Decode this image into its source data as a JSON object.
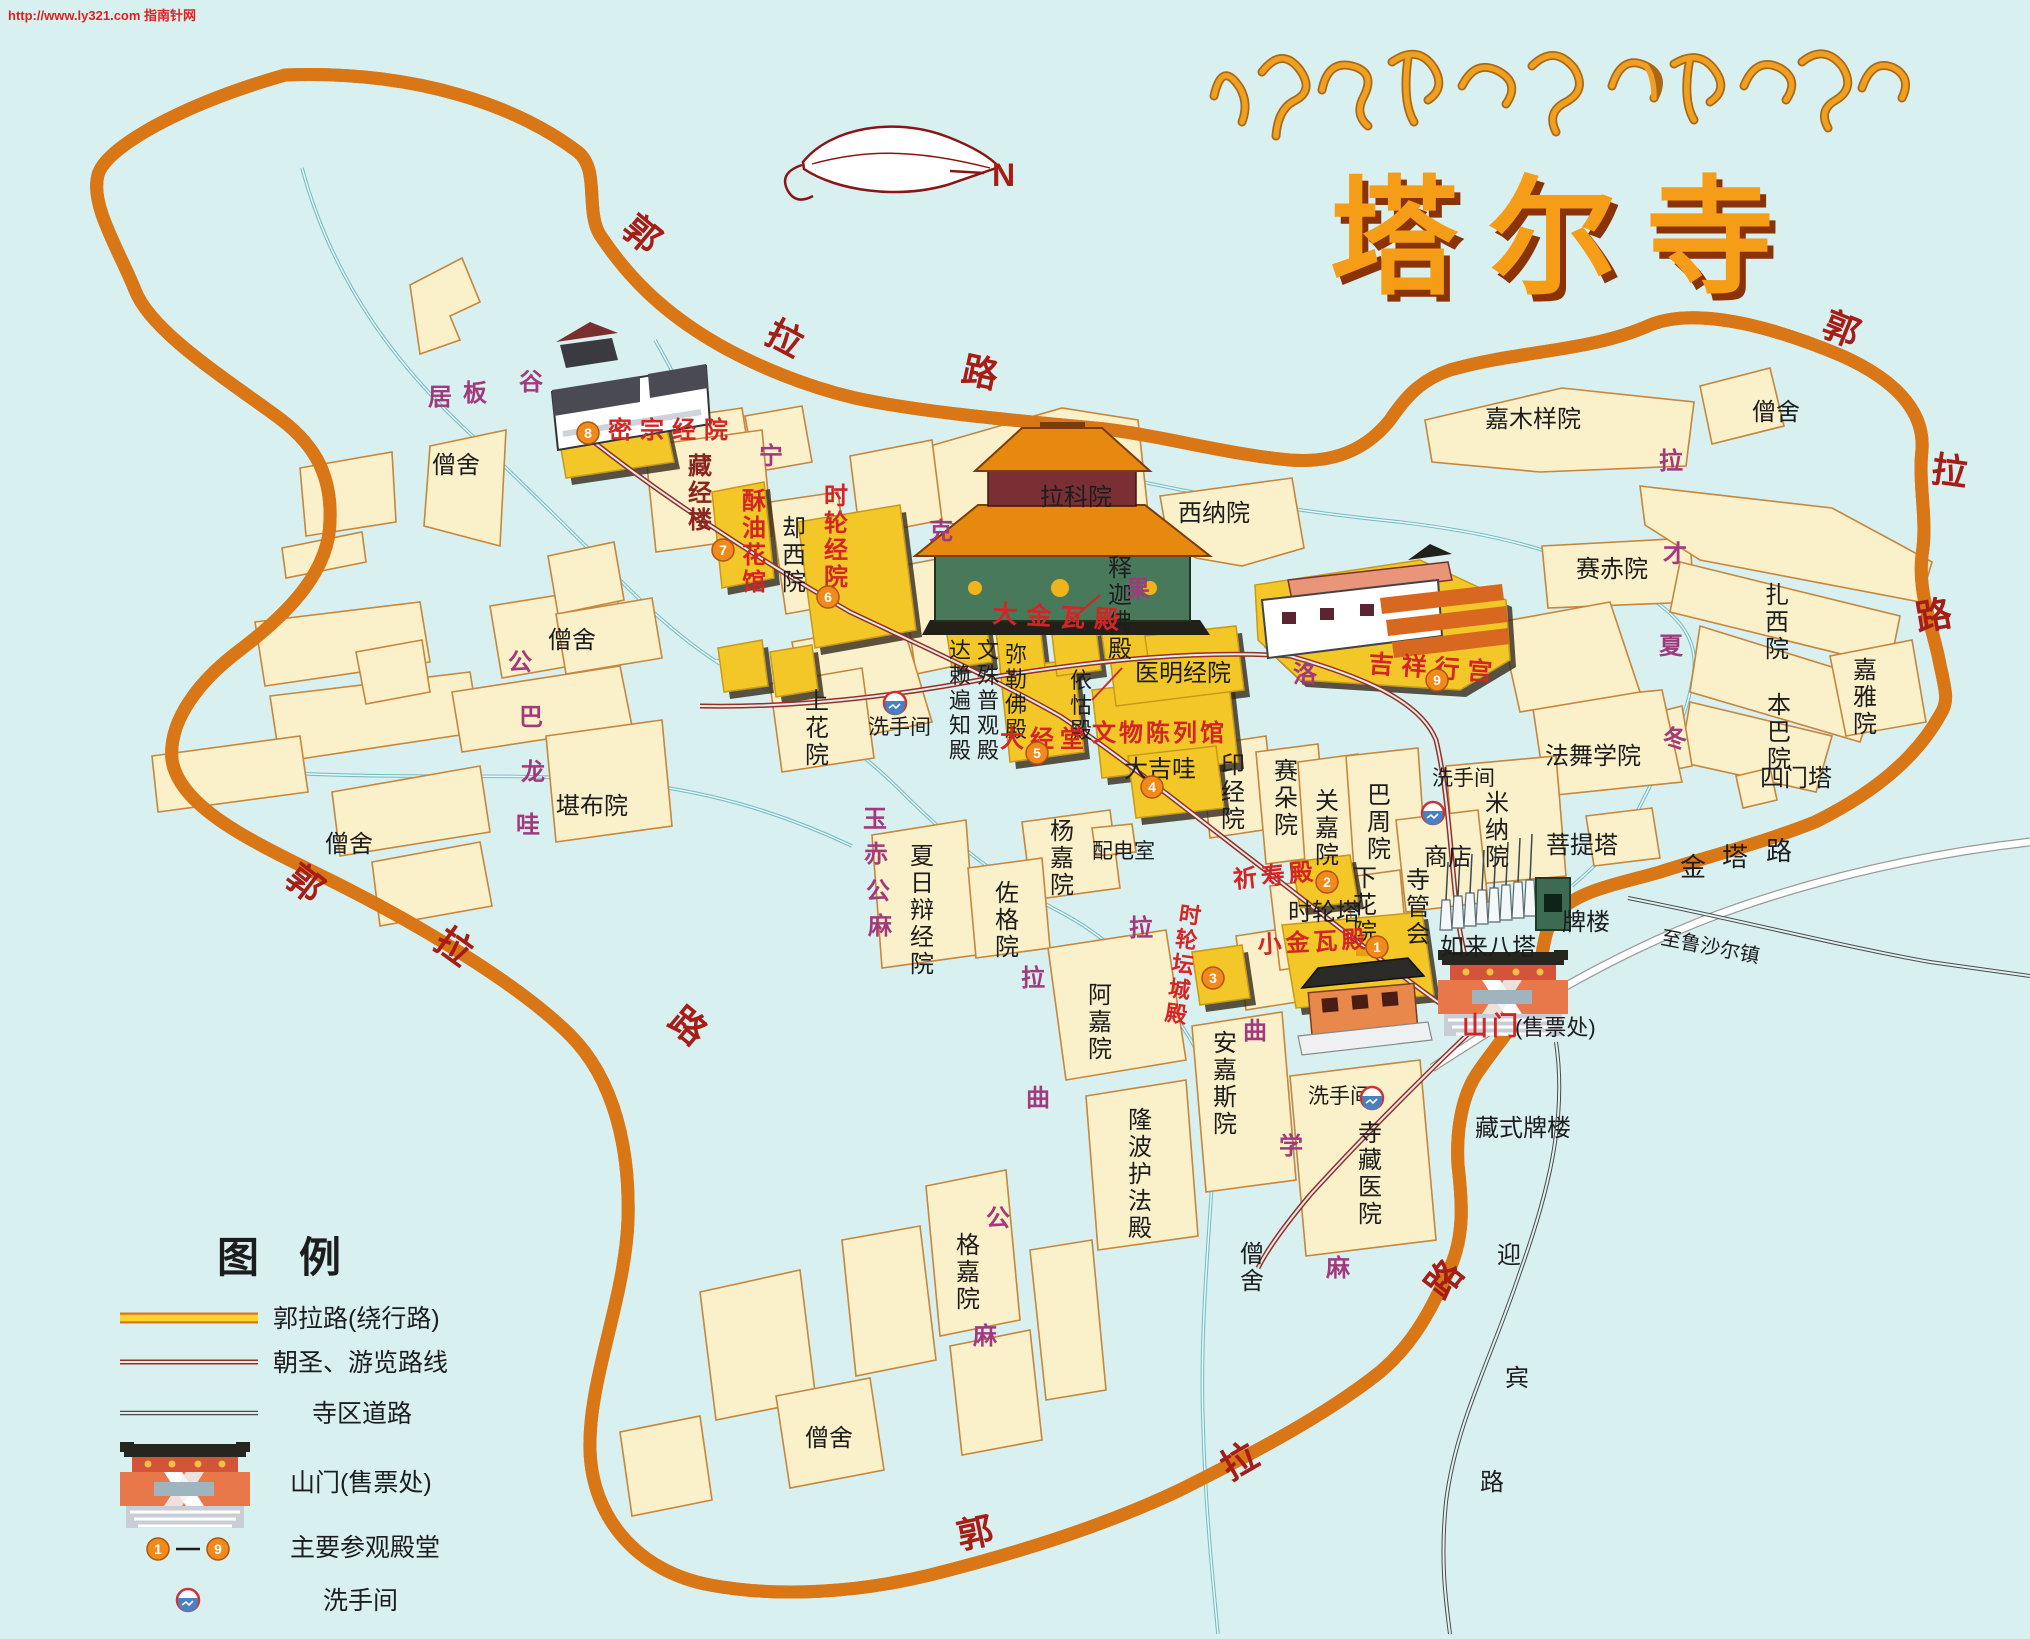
{
  "meta": {
    "url_watermark": "http://www.ly321.com 指南针网"
  },
  "header": {
    "tibetan_title": "སྐུ་འབུམ་བྱམས་པ་གླིང་",
    "title": "塔尔寺",
    "compass_label": "N"
  },
  "legend": {
    "title": "图例",
    "items": [
      {
        "symbol": "ring-road-line",
        "label": "郭拉路(绕行路)"
      },
      {
        "symbol": "pilgrim-route-line",
        "label": "朝圣、游览路线"
      },
      {
        "symbol": "temple-road-line",
        "label": "寺区道路"
      },
      {
        "symbol": "gate-icon",
        "label": "山门(售票处)"
      },
      {
        "symbol": "numbered-badges-1-9",
        "label": "主要参观殿堂",
        "range_dash": "—"
      },
      {
        "symbol": "toilet-icon",
        "label": "洗手间"
      }
    ]
  },
  "map": {
    "colors": {
      "background": "#d9f0f1",
      "ring_road_fill": "#ffd42e",
      "ring_road_casing": "#d97716",
      "pilgrim_route": "#9b2d23",
      "temple_road": "#4a4a48",
      "stream": "#79bcc4",
      "building_fill": "#faf0c9",
      "building_stroke": "#c6863b",
      "highlight_hall_fill": "#f3c728",
      "hall_label_red": "#d42525",
      "road_char_red": "#a51d15",
      "area_char_purple": "#a13a7c",
      "black_text": "#1d1d1d"
    },
    "labels": [
      {
        "t": "僧舍",
        "x": 432,
        "y": 473
      },
      {
        "t": "僧舍",
        "x": 548,
        "y": 648
      },
      {
        "t": "僧舍",
        "x": 325,
        "y": 852
      },
      {
        "t": "僧舍",
        "x": 1752,
        "y": 420
      },
      {
        "t": "僧舍",
        "x": 805,
        "y": 1446
      },
      {
        "t": "僧舍",
        "x": 1240,
        "y": 1262,
        "o": "v"
      },
      {
        "t": "拉科院",
        "x": 1040,
        "y": 505
      },
      {
        "t": "西纳院",
        "x": 1178,
        "y": 521
      },
      {
        "t": "嘉木样院",
        "x": 1485,
        "y": 427
      },
      {
        "t": "赛赤院",
        "x": 1576,
        "y": 577
      },
      {
        "t": "医明经院",
        "x": 1135,
        "y": 681
      },
      {
        "t": "大吉哇",
        "x": 1124,
        "y": 777
      },
      {
        "t": "堪布院",
        "x": 556,
        "y": 814
      },
      {
        "t": "配电室",
        "x": 1092,
        "y": 858,
        "fs": 21
      },
      {
        "t": "商店",
        "x": 1424,
        "y": 865
      },
      {
        "t": "菩提塔",
        "x": 1546,
        "y": 853
      },
      {
        "t": "法舞学院",
        "x": 1545,
        "y": 764
      },
      {
        "t": "牌楼",
        "x": 1562,
        "y": 930
      },
      {
        "t": "如来八塔",
        "x": 1440,
        "y": 955
      },
      {
        "t": "时轮塔",
        "x": 1288,
        "y": 920
      },
      {
        "t": "藏式牌楼",
        "x": 1475,
        "y": 1136
      },
      {
        "t": "四门塔",
        "x": 1760,
        "y": 786
      },
      {
        "t": "(售票处)",
        "x": 1515,
        "y": 1035,
        "fs": 22
      },
      {
        "t": "洗手间",
        "x": 868,
        "y": 734,
        "fs": 21
      },
      {
        "t": "洗手间",
        "x": 1432,
        "y": 785,
        "fs": 21
      },
      {
        "t": "洗手间",
        "x": 1308,
        "y": 1103,
        "fs": 21
      },
      {
        "t": "金",
        "x": 1680,
        "y": 876,
        "fs": 26
      },
      {
        "t": "塔",
        "x": 1722,
        "y": 866,
        "fs": 26
      },
      {
        "t": "路",
        "x": 1766,
        "y": 860,
        "fs": 26
      },
      {
        "t": "至鲁沙尔镇",
        "x": 1660,
        "y": 944,
        "fs": 20,
        "rot": 11
      },
      {
        "t": "迎",
        "x": 1497,
        "y": 1263
      },
      {
        "t": "宾",
        "x": 1505,
        "y": 1386
      },
      {
        "t": "路",
        "x": 1480,
        "y": 1490
      },
      {
        "t": "却西院",
        "x": 782,
        "y": 536,
        "o": "v"
      },
      {
        "t": "释迦佛殿",
        "x": 1108,
        "y": 576,
        "o": "v"
      },
      {
        "t": "达赖遍知殿",
        "x": 949,
        "y": 658,
        "o": "v",
        "fs": 22
      },
      {
        "t": "文殊普观殿",
        "x": 977,
        "y": 658,
        "o": "v",
        "fs": 22
      },
      {
        "t": "弥勒佛殿",
        "x": 1005,
        "y": 662,
        "o": "v",
        "fs": 22
      },
      {
        "t": "依怙殿",
        "x": 1070,
        "y": 688,
        "o": "v",
        "fs": 22
      },
      {
        "t": "上花院",
        "x": 805,
        "y": 709,
        "o": "v"
      },
      {
        "t": "印经院",
        "x": 1221,
        "y": 773,
        "o": "v"
      },
      {
        "t": "赛朵院",
        "x": 1274,
        "y": 779,
        "o": "v"
      },
      {
        "t": "关嘉院",
        "x": 1315,
        "y": 809,
        "o": "v"
      },
      {
        "t": "巴周院",
        "x": 1367,
        "y": 803,
        "o": "v"
      },
      {
        "t": "米纳院",
        "x": 1485,
        "y": 811,
        "o": "v"
      },
      {
        "t": "寺管会",
        "x": 1406,
        "y": 888,
        "o": "v"
      },
      {
        "t": "下花院",
        "x": 1353,
        "y": 886,
        "o": "v"
      },
      {
        "t": "杨嘉院",
        "x": 1050,
        "y": 839,
        "o": "v"
      },
      {
        "t": "佐格院",
        "x": 995,
        "y": 901,
        "o": "v"
      },
      {
        "t": "夏日辩经院",
        "x": 910,
        "y": 864,
        "o": "v"
      },
      {
        "t": "阿嘉院",
        "x": 1088,
        "y": 1003,
        "o": "v"
      },
      {
        "t": "安嘉斯院",
        "x": 1213,
        "y": 1051,
        "o": "v"
      },
      {
        "t": "隆波护法殿",
        "x": 1128,
        "y": 1128,
        "o": "v"
      },
      {
        "t": "格嘉院",
        "x": 956,
        "y": 1253,
        "o": "v"
      },
      {
        "t": "寺藏医院",
        "x": 1358,
        "y": 1141,
        "o": "v"
      },
      {
        "t": "扎西院",
        "x": 1765,
        "y": 603,
        "o": "v"
      },
      {
        "t": "嘉雅院",
        "x": 1853,
        "y": 678,
        "o": "v"
      },
      {
        "t": "本巴院",
        "x": 1767,
        "y": 713,
        "o": "v"
      },
      {
        "t": "密宗经院",
        "x": 608,
        "y": 438,
        "c": "r",
        "ls": 8
      },
      {
        "t": "酥油花馆",
        "x": 742,
        "y": 509,
        "c": "r",
        "o": "v"
      },
      {
        "t": "时轮经院",
        "x": 824,
        "y": 504,
        "c": "r",
        "o": "v"
      },
      {
        "t": "大金瓦殿",
        "x": 992,
        "y": 622,
        "c": "r",
        "ls": 9,
        "rot": 3,
        "fs": 25
      },
      {
        "t": "大经堂",
        "x": 1000,
        "y": 747,
        "c": "r",
        "ls": 6
      },
      {
        "t": "文物陈列馆",
        "x": 1092,
        "y": 741,
        "c": "r",
        "ls": 3
      },
      {
        "t": "吉祥行宫",
        "x": 1368,
        "y": 672,
        "c": "r",
        "ls": 8,
        "rot": 4,
        "fs": 25
      },
      {
        "t": "祈寿殿",
        "x": 1234,
        "y": 888,
        "c": "r",
        "rot": -6,
        "ls": 4
      },
      {
        "t": "小金瓦殿",
        "x": 1258,
        "y": 953,
        "c": "r",
        "ls": 4,
        "rot": -3
      },
      {
        "t": "时轮坛城殿",
        "x": 1178,
        "y": 921,
        "c": "r",
        "o": "v",
        "rot": 8,
        "fs": 22
      },
      {
        "t": "山门",
        "x": 1462,
        "y": 1035,
        "c": "r",
        "fs": 26,
        "ls": 4
      },
      {
        "t": "藏经楼",
        "x": 688,
        "y": 474,
        "c": "m",
        "o": "v"
      },
      {
        "t": "居",
        "x": 428,
        "y": 405,
        "c": "p"
      },
      {
        "t": "板",
        "x": 463,
        "y": 401,
        "c": "p"
      },
      {
        "t": "谷",
        "x": 519,
        "y": 390,
        "c": "p"
      },
      {
        "t": "公",
        "x": 508,
        "y": 670,
        "c": "p"
      },
      {
        "t": "巴",
        "x": 519,
        "y": 725,
        "c": "p"
      },
      {
        "t": "龙",
        "x": 521,
        "y": 780,
        "c": "p"
      },
      {
        "t": "哇",
        "x": 516,
        "y": 833,
        "c": "p"
      },
      {
        "t": "玉",
        "x": 863,
        "y": 827,
        "c": "p"
      },
      {
        "t": "赤",
        "x": 864,
        "y": 862,
        "c": "p"
      },
      {
        "t": "公",
        "x": 866,
        "y": 899,
        "c": "p"
      },
      {
        "t": "麻",
        "x": 868,
        "y": 934,
        "c": "p"
      },
      {
        "t": "宁",
        "x": 759,
        "y": 464,
        "c": "p"
      },
      {
        "t": "克",
        "x": 929,
        "y": 539,
        "c": "p"
      },
      {
        "t": "果",
        "x": 1126,
        "y": 597,
        "c": "p"
      },
      {
        "t": "洛",
        "x": 1293,
        "y": 682,
        "c": "p"
      },
      {
        "t": "拉",
        "x": 1021,
        "y": 986,
        "c": "p"
      },
      {
        "t": "曲",
        "x": 1026,
        "y": 1106,
        "c": "p"
      },
      {
        "t": "公",
        "x": 986,
        "y": 1226,
        "c": "p"
      },
      {
        "t": "麻",
        "x": 973,
        "y": 1344,
        "c": "p"
      },
      {
        "t": "拉",
        "x": 1129,
        "y": 936,
        "c": "p"
      },
      {
        "t": "曲",
        "x": 1243,
        "y": 1039,
        "c": "p"
      },
      {
        "t": "学",
        "x": 1279,
        "y": 1154,
        "c": "p"
      },
      {
        "t": "麻",
        "x": 1326,
        "y": 1276,
        "c": "p"
      },
      {
        "t": "拉",
        "x": 1659,
        "y": 469,
        "c": "p"
      },
      {
        "t": "才",
        "x": 1663,
        "y": 562,
        "c": "p"
      },
      {
        "t": "夏",
        "x": 1659,
        "y": 654,
        "c": "p"
      },
      {
        "t": "冬",
        "x": 1663,
        "y": 747,
        "c": "p"
      },
      {
        "t": "郭",
        "x": 620,
        "y": 232,
        "c": "d",
        "fs": 36,
        "rot": 40
      },
      {
        "t": "拉",
        "x": 763,
        "y": 341,
        "c": "d",
        "fs": 36,
        "rot": 28
      },
      {
        "t": "路",
        "x": 960,
        "y": 381,
        "c": "d",
        "fs": 36,
        "rot": 12
      },
      {
        "t": "郭",
        "x": 1820,
        "y": 334,
        "c": "d",
        "fs": 36,
        "rot": 22
      },
      {
        "t": "拉",
        "x": 1930,
        "y": 481,
        "c": "d",
        "fs": 36,
        "rot": 8
      },
      {
        "t": "路",
        "x": 1918,
        "y": 631,
        "c": "d",
        "fs": 36,
        "rot": -10
      },
      {
        "t": "郭",
        "x": 283,
        "y": 882,
        "c": "d",
        "fs": 36,
        "rot": 38
      },
      {
        "t": "拉",
        "x": 432,
        "y": 946,
        "c": "d",
        "fs": 36,
        "rot": 36
      },
      {
        "t": "路",
        "x": 666,
        "y": 1024,
        "c": "d",
        "fs": 36,
        "rot": 40
      },
      {
        "t": "郭",
        "x": 960,
        "y": 1549,
        "c": "d",
        "fs": 36,
        "rot": -12
      },
      {
        "t": "拉",
        "x": 1230,
        "y": 1481,
        "c": "d",
        "fs": 36,
        "rot": -30
      },
      {
        "t": "路",
        "x": 1443,
        "y": 1301,
        "c": "d",
        "fs": 36,
        "rot": -52
      },
      {
        "t": "郭拉路(绕行路)",
        "x": 273,
        "y": 1327,
        "fs": 25
      },
      {
        "t": "朝圣、游览路线",
        "x": 273,
        "y": 1371,
        "fs": 25
      },
      {
        "t": "寺区道路",
        "x": 312,
        "y": 1422,
        "fs": 25
      },
      {
        "t": "山门(售票处)",
        "x": 290,
        "y": 1491,
        "fs": 25
      },
      {
        "t": "主要参观殿堂",
        "x": 290,
        "y": 1556,
        "fs": 25
      },
      {
        "t": "洗手间",
        "x": 323,
        "y": 1609,
        "fs": 25
      }
    ],
    "badges": [
      {
        "n": "1",
        "x": 1377,
        "y": 947
      },
      {
        "n": "2",
        "x": 1327,
        "y": 882
      },
      {
        "n": "3",
        "x": 1213,
        "y": 978
      },
      {
        "n": "4",
        "x": 1152,
        "y": 787
      },
      {
        "n": "5",
        "x": 1037,
        "y": 753
      },
      {
        "n": "6",
        "x": 828,
        "y": 597
      },
      {
        "n": "7",
        "x": 723,
        "y": 550
      },
      {
        "n": "8",
        "x": 588,
        "y": 433
      },
      {
        "n": "9",
        "x": 1437,
        "y": 680
      },
      {
        "n": "1",
        "x": 158,
        "y": 1549
      },
      {
        "n": "9",
        "x": 218,
        "y": 1549
      }
    ],
    "toilets": [
      {
        "x": 895,
        "y": 703
      },
      {
        "x": 1433,
        "y": 813
      },
      {
        "x": 1372,
        "y": 1098
      },
      {
        "x": 188,
        "y": 1600
      }
    ]
  }
}
